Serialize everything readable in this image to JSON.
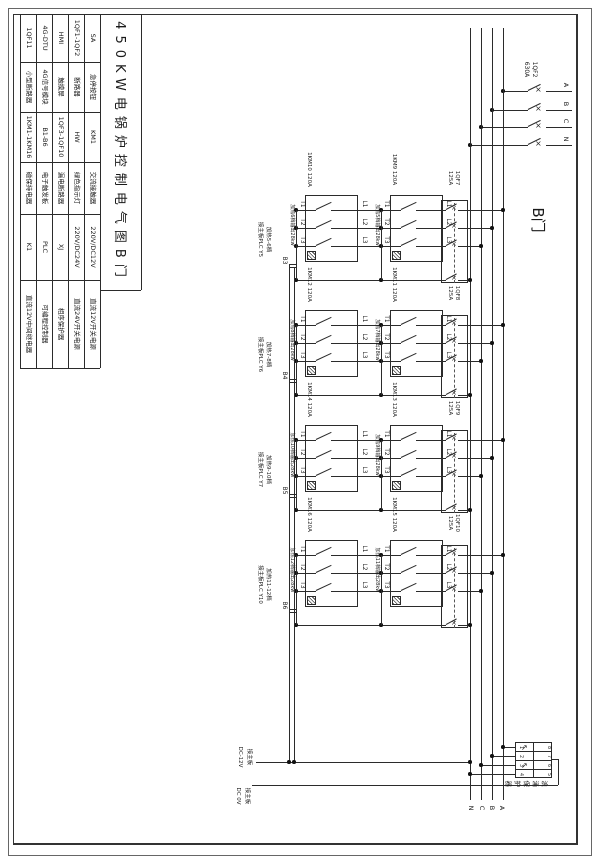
{
  "title": "450KW电锅炉控制电气图B门",
  "door_label": "B门",
  "legend": {
    "columns": [
      {
        "cells": [
          "1QF11",
          "小型断路器",
          "1KM1-1KM16",
          "磁保持电器",
          "K1",
          "直流12V中间继电器"
        ]
      },
      {
        "cells": [
          "4G-DTU",
          "4G信号模块",
          "B1-B6",
          "电子触发板",
          "PLC",
          "可编程控制器"
        ]
      },
      {
        "cells": [
          "HMI",
          "触摸屏",
          "1QF3-1QF10",
          "漏电断路器",
          "XJ",
          "相序保护器"
        ]
      },
      {
        "cells": [
          "1QF1-1QF2",
          "断路器",
          "HW",
          "绿色指示灯",
          "220V/DC24V",
          "直流24V开关电源"
        ]
      },
      {
        "cells": [
          "SA",
          "急停按钮",
          "KM1",
          "交流接触器",
          "220V/DC12V",
          "直流12V开关电源"
        ]
      }
    ]
  },
  "main_breaker_label": "1QF2\n630A",
  "phases_top": [
    "A",
    "B",
    "C",
    "N"
  ],
  "phases_bottom": [
    "N",
    "C",
    "B",
    "A"
  ],
  "t_labels": [
    "T1",
    "T2",
    "T3"
  ],
  "l_labels": [
    "L1",
    "L2",
    "L3"
  ],
  "groups": [
    {
      "km_left": "1KM10 120A",
      "km_right": "1KM9 120A",
      "qf": "1QF7\n125A",
      "stage_left": "加热6档输出28kw",
      "stage_right": "加热5档输出28kw",
      "label": "加热5-6档\n接主板PLC Y5",
      "tag": "B3"
    },
    {
      "km_left": "1KM12 120A",
      "km_right": "1KM11 120A",
      "qf": "1QF8\n125A",
      "stage_left": "加热8档输出28kw",
      "stage_right": "加热7档输出28kw",
      "label": "加热7-8档\n接主板PLC Y6",
      "tag": "B4"
    },
    {
      "km_left": "1KM14 120A",
      "km_right": "1KM13 120A",
      "qf": "1QF9\n125A",
      "stage_left": "加热10档输出28kw",
      "stage_right": "加热9档输出28kw",
      "label": "加热9-10档\n接主板PLC Y7",
      "tag": "B5"
    },
    {
      "km_left": "1KM16 120A",
      "km_right": "1KM15 120A",
      "qf": "1QF10\n125A",
      "stage_left": "加热12档输出28kw",
      "stage_right": "加热11档输出28kw",
      "label": "加热11-12档\n接主板PLC Y10",
      "tag": "B6"
    }
  ],
  "bottom_labels": [
    {
      "text": "接主板\nDC-12V"
    },
    {
      "text": "接主板\nDC 0V"
    }
  ],
  "surge": {
    "label": "浪涌保护器",
    "left_terminals": [
      "1",
      "2",
      "3",
      "4"
    ],
    "right_terminals": [
      "8",
      "7",
      "6",
      "5"
    ]
  },
  "marks": {
    "breaker": "×",
    "surge_arrow": "↗"
  },
  "colors": {
    "line": "#2b2b2b",
    "paper": "#ffffff"
  }
}
